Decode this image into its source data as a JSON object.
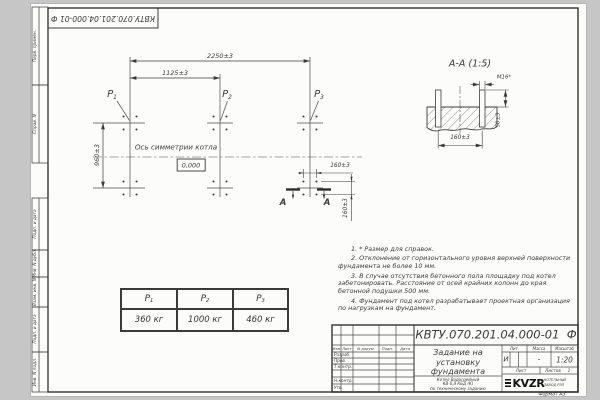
{
  "page": {
    "format_label": "Формат А3"
  },
  "top_stamp": {
    "text": "КВТУ.070.201.04.000-01 Ф"
  },
  "side_labels": [
    "Перв. примен.",
    "Справ. N",
    "Подп. и дата",
    "Инв. N дубл.",
    "Взам. инв. N",
    "Подп. и дата",
    "Инв. N подл."
  ],
  "plan": {
    "dim_width_total": "2250±3",
    "dim_width_half": "1125±3",
    "dim_depth": "960±3",
    "axis_label": "Ось симметрии котла",
    "elevation": "0,000",
    "p_symbol": "P",
    "p_subs": [
      "1",
      "2",
      "3"
    ],
    "cut_dim_h": "160±3",
    "cut_dim_v": "160±3",
    "cut_letter": "А"
  },
  "section": {
    "title": "А-А (1:5)",
    "thread_label": "М16*",
    "dim_protrusion": "50±3",
    "dim_spacing": "160±3"
  },
  "notes": [
    "1. * Размер для справок.",
    "2. Отклонение от горизонтального уровня верхней поверхности фундамента не более 10 мм.",
    "3. В случае отсутствия бетонного пола площадку под котел забетонировать. Расстояние от осей крайних колонн до края бетонной подушки 500 мм.",
    "4. Фундамент под котел разрабатывает проектная организация по нагрузкам на фундамент."
  ],
  "load_table": {
    "p_symbol": "P",
    "subs": [
      "1",
      "2",
      "3"
    ],
    "values": [
      "360 кг",
      "1000 кг",
      "460 кг"
    ]
  },
  "title_block": {
    "doc_number": "КВТУ.070.201.04.000-01  Ф",
    "rev_headers": [
      "Изм",
      "Лист",
      "N докум.",
      "Подп.",
      "Дата"
    ],
    "row_labels": [
      "Разраб.",
      "Пров.",
      "Т.контр.",
      "Н.контр.",
      "Утв."
    ],
    "title_lines": [
      "Задание на",
      "установку",
      "фундамента"
    ],
    "product_lines": [
      "Котел Водогрейный",
      "КВ-0,8 КБД (К)",
      "по техническому заданию"
    ],
    "lit_header": "Лит.",
    "mass_header": "Масса",
    "scale_header": "Масштаб",
    "lit_value": "И",
    "mass_value": "-",
    "scale_value": "1:20",
    "sheet_label": "Лист",
    "sheets_label": "Листов",
    "sheets_value": "1",
    "logo_text": "KVZR",
    "logo_caption_1": "КОТЕЛЬНЫЙ",
    "logo_caption_2": "ЗАВОД РЭП"
  }
}
